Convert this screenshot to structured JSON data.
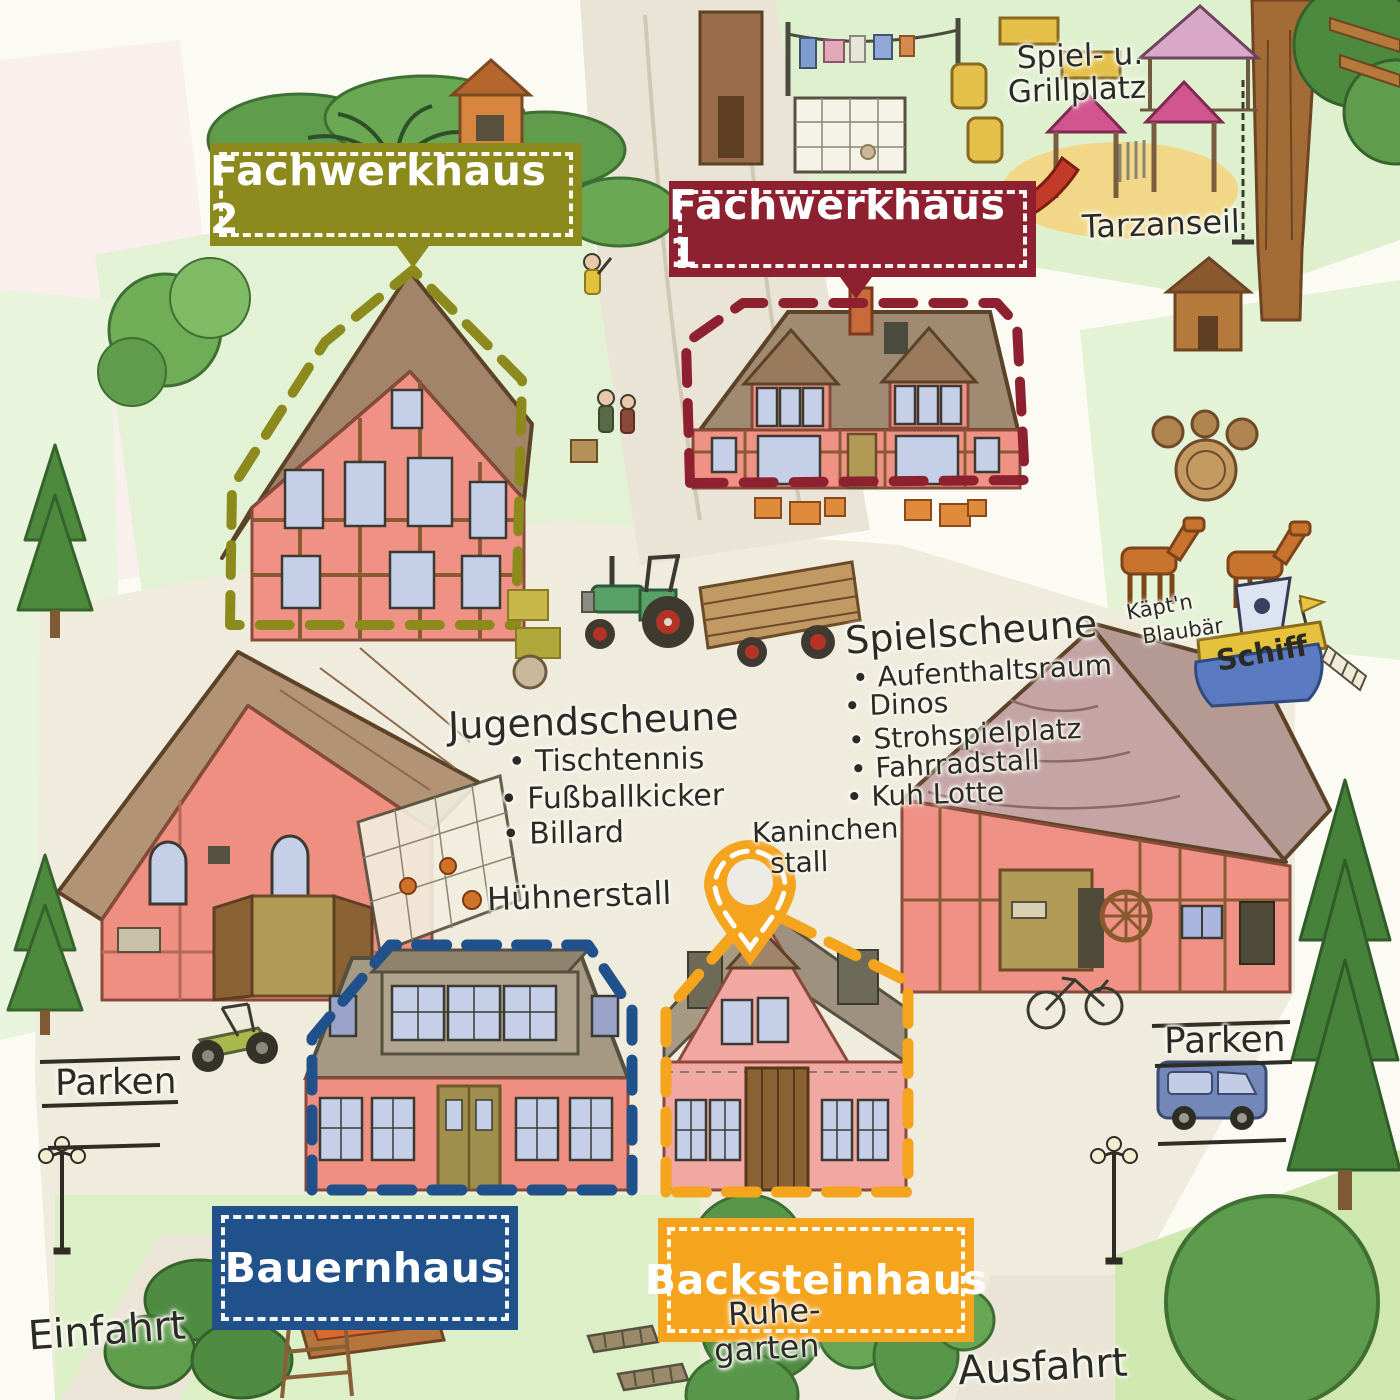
{
  "map": {
    "tags": [
      {
        "id": "fachwerkhaus2",
        "label": "Fachwerkhaus 2",
        "color": "#8c8a1c"
      },
      {
        "id": "fachwerkhaus1",
        "label": "Fachwerkhaus 1",
        "color": "#8e2130"
      },
      {
        "id": "bauernhaus",
        "label": "Bauernhaus",
        "color": "#20518b"
      },
      {
        "id": "backsteinhaus",
        "label": "Backsteinhaus",
        "color": "#f5a41e"
      }
    ],
    "annotations": {
      "spielplatz": {
        "line1": "Spiel- u.",
        "line2": "Grillplatz"
      },
      "tarzanseil": "Tarzanseil",
      "spielscheune": {
        "title": "Spielscheune",
        "items": [
          "Aufenthaltsraum",
          "Dinos",
          "Strohspielplatz",
          "Fahrradstall",
          "Kuh Lotte"
        ]
      },
      "jugendscheune": {
        "title": "Jugendscheune",
        "items": [
          "Tischtennis",
          "Fußballkicker",
          "Billard"
        ]
      },
      "huehnerstall": "Hühnerstall",
      "kaninchenstall": {
        "line1": "Kaninchen",
        "line2": "stall"
      },
      "schiff": {
        "line1": "Käpt'n",
        "line2": "Blaubär",
        "boat": "Schiff"
      },
      "parken_left": "Parken",
      "parken_right": "Parken",
      "einfahrt": "Einfahrt",
      "ausfahrt": "Ausfahrt",
      "ruhegarten": {
        "line1": "Ruhe-",
        "line2": "garten"
      }
    },
    "colors": {
      "tag_olive": "#8c8a1c",
      "tag_dark_red": "#8e2130",
      "tag_blue": "#20518b",
      "tag_orange": "#f5a41e",
      "pin_orange": "#f5a41e",
      "ink": "#2b2b26"
    },
    "icons": {
      "pin": "location-pin-icon"
    }
  }
}
